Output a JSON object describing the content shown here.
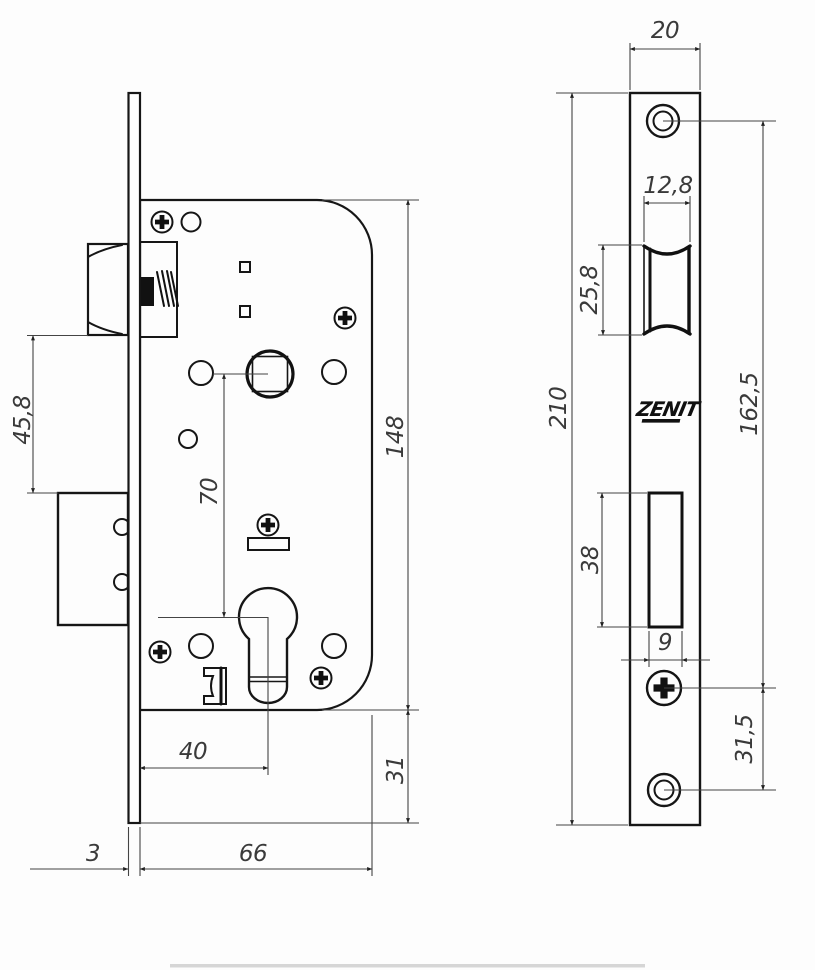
{
  "drawing": {
    "brand": "ZENIT",
    "dims": {
      "left": {
        "latch_to_deadbolt": "45,8",
        "spindle_to_cylinder": "70",
        "case_height": "148",
        "backset": "40",
        "plate_overhang_bottom": "31",
        "plate_thickness": "3",
        "case_depth": "66"
      },
      "right": {
        "plate_width": "20",
        "latch_cutout_width": "12,8",
        "latch_cutout_height": "25,8",
        "plate_length": "210",
        "screw_spacing": "162,5",
        "bolt_cutout_height": "38",
        "bolt_cutout_width": "9",
        "screw_to_hole": "31,5"
      }
    }
  }
}
